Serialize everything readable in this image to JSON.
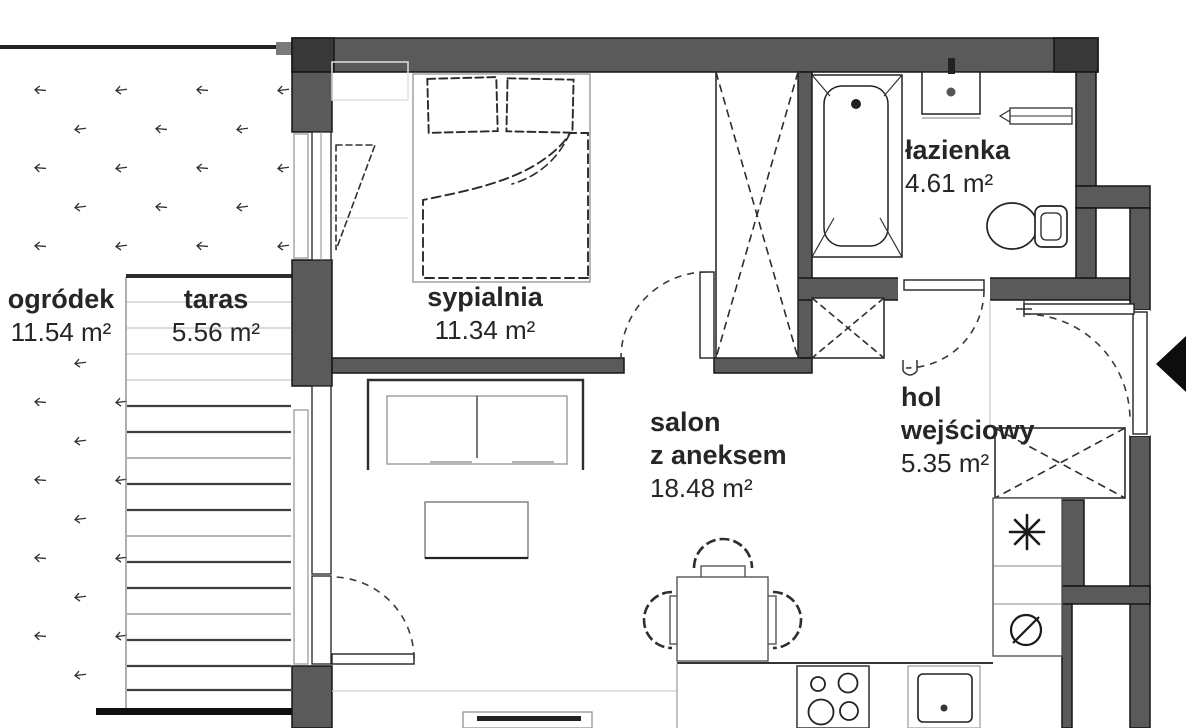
{
  "plan_title": "apartment floor plan",
  "rooms": {
    "ogrodek": {
      "name": "ogródek",
      "area": "11.54 m²"
    },
    "taras": {
      "name": "taras",
      "area": "5.56 m²"
    },
    "sypialnia": {
      "name": "sypialnia",
      "area": "11.34 m²"
    },
    "lazienka": {
      "name": "łazienka",
      "area": "4.61 m²"
    },
    "salon": {
      "line1": "salon",
      "line2": "z aneksem",
      "area": "18.48 m²"
    },
    "hol": {
      "line1": "hol",
      "line2": "wejściowy",
      "area": "5.35 m²"
    }
  },
  "symbols": {
    "freezer": "✳",
    "washer": "∅",
    "entrance_arrow": "◄"
  },
  "colors": {
    "wall": "#5a5a5a",
    "wall_dark": "#383838",
    "line": "#1a1a1a",
    "text": "#262626",
    "light_line": "#c7c7c7"
  }
}
